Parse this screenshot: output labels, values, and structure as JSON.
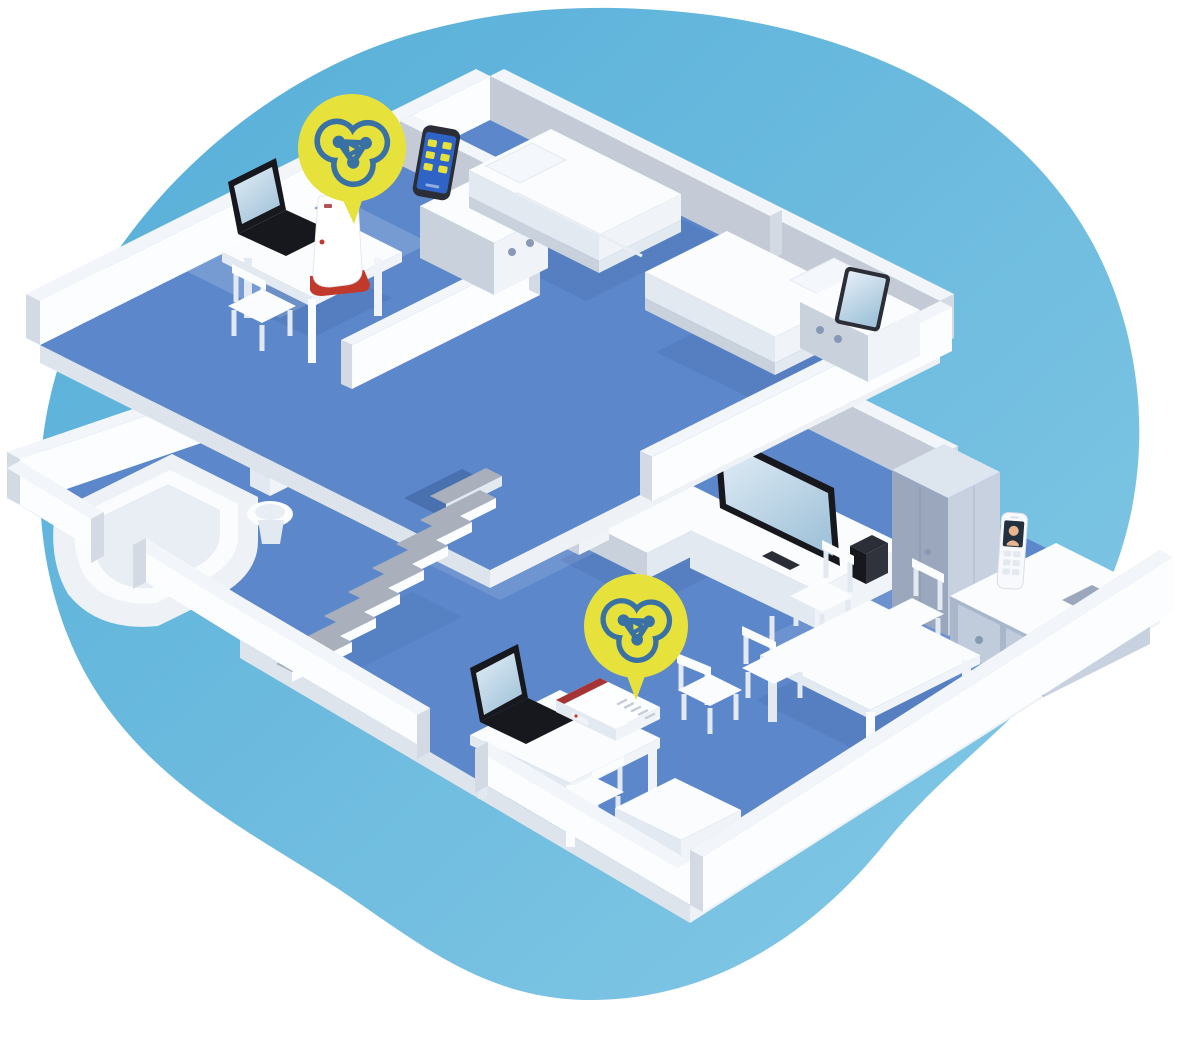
{
  "scene": {
    "title": "Isometric two-story home with mesh Wi-Fi network coverage",
    "floors": [
      "upper floor",
      "ground floor"
    ],
    "upper_rooms": [
      "home office",
      "bedroom 1",
      "bedroom 2"
    ],
    "lower_rooms": [
      "bathroom",
      "stair hall",
      "living room",
      "dining area",
      "study corner"
    ],
    "network_devices": [
      "wifi-router",
      "wifi-repeater"
    ],
    "client_devices": [
      "laptop-upstairs",
      "smartphone",
      "tablet",
      "tv",
      "set-top-box",
      "cordless-phone",
      "laptop-downstairs"
    ],
    "furniture": [
      "desk",
      "chair",
      "dresser",
      "bed",
      "bathtub",
      "toilet",
      "staircase",
      "sofa",
      "tv-lowboard",
      "wardrobe",
      "sideboard",
      "dining-table",
      "storage-box"
    ],
    "mesh_badges": 2
  },
  "icons": [
    "mesh-network-icon"
  ],
  "palette": {
    "bg": "#ffffff",
    "blob-1": "#55aed8",
    "blob-2": "#85c9e6",
    "floor": "#5c87ca",
    "slab": "#dde4ec",
    "slab-light": "#eef2f7",
    "wall-top": "#f2f5f9",
    "wall-bright": "#fbfdff",
    "wall-shade": "#c4cbd7",
    "wall-mid": "#d4dae3",
    "furn-top": "#fafcfe",
    "furn-side": "#e3e9f0",
    "furn-side2": "#f0f4f8",
    "furn-shade": "#c9d1dc",
    "step-gray": "#a9b0bb",
    "cab-top": "#dde5ee",
    "cab-left": "#9aa7bd",
    "cab-right": "#c7d1e0",
    "drawer": "#a9b7cd",
    "drawer-front": "#c0ccdc",
    "knob": "#8799b5",
    "device-dark": "#17181d",
    "device-dark2": "#2b2e36",
    "screen-1": "#e3eef7",
    "screen-2": "#a3c4da",
    "phone-blue": "#2f63c5",
    "brand-red": "#a63434",
    "brand-red2": "#c0392b",
    "mesh-yellow": "#e7e23b",
    "mesh-blue": "#3a71a5",
    "skin": "#e8b48d"
  }
}
